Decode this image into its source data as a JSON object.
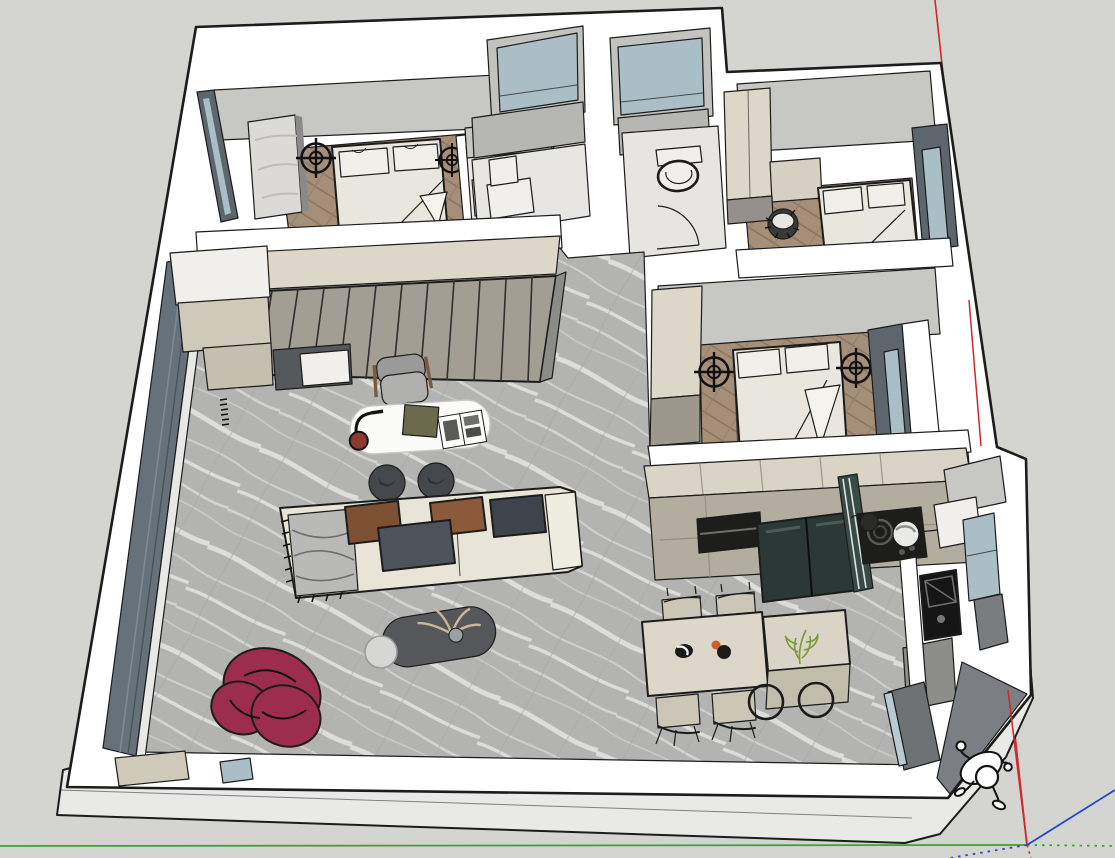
{
  "meta": {
    "viewport": "3d-architecture-model-viewport",
    "style": "sketchup-like-edge-render",
    "canvas_width": 1115,
    "canvas_height": 858
  },
  "palette": {
    "bg": "#d4d4d1",
    "slab": "#e9e9e7",
    "wall_white": "#ffffff",
    "outline": "#1c1c1c",
    "face_gray": "#c7c7c4",
    "face_gray2": "#b6b6b3",
    "reveal_dark": "#5d666c",
    "glass_blue": "#a9bfc5",
    "glass_slate": "#667179",
    "marble_base": "#b3b3b1",
    "marble_vein": "#ebebe9",
    "wood_base": "#a68f79",
    "wood_groove": "#89735e",
    "wardrobe_top": "#dcd7c9",
    "wardrobe_face": "#a39e94",
    "cabinet_beige": "#cfc9ba",
    "counter_top": "#d9d4c6",
    "counter_face": "#b3ada0",
    "dark_appliance": "#1d1d1c",
    "fridge": "#2c3836",
    "fridge_glass": "#3a4a46",
    "bed_cream": "#e9e6de",
    "pillow": "#f1efe9",
    "white_box": "#f0efeb",
    "sofa": "#e8e4d8",
    "cushion_brown1": "#7d4f33",
    "cushion_brown2": "#8a5a3a",
    "cushion_dark1": "#4e525a",
    "cushion_dark2": "#3f434b",
    "throw_gray": "#b9b9b7",
    "armchair": "#9c2d50",
    "coffee_table": "#55575b",
    "side_table": "#d6d6d4",
    "desk": "#fbfbfa",
    "stool_dark": "#44474c",
    "dining_table": "#dcd7c9",
    "chair_beige": "#ccc6b6",
    "island": "#d9d4c6",
    "plant_green": "#7a9a3a",
    "door_dark": "#6e7275",
    "entry_wedge": "#7b7f83",
    "lamp_base_red": "#8d3a30",
    "axis_red": "#cc2a2a",
    "axis_green": "#3aa335",
    "axis_blue": "#2047c8",
    "symbol_black": "#111111"
  },
  "axes": {
    "origin_x": 1027,
    "origin_y": 845,
    "red_solid": "vertical-axis-through-model",
    "green_solid": "left-of-origin",
    "green_dotted": "right-of-origin",
    "blue_solid": "up-right-of-origin",
    "blue_dotted": "down-left-of-origin"
  },
  "scene": {
    "rooms": [
      {
        "name": "bedroom-1",
        "floor": "herringbone-wood",
        "items": [
          "double-bed",
          "pillows",
          "ceiling-light-symbol x2",
          "marble-side-cabinet",
          "window",
          "niche-vanity"
        ]
      },
      {
        "name": "laundry-room",
        "items": [
          "window",
          "washer-boxes"
        ]
      },
      {
        "name": "storage-room",
        "items": [
          "window"
        ]
      },
      {
        "name": "bathroom",
        "items": [
          "toilet",
          "door-swing-arc"
        ]
      },
      {
        "name": "bedroom-2",
        "floor": "herringbone-wood",
        "items": [
          "bed",
          "wardrobe",
          "fringed-pouf",
          "window"
        ]
      },
      {
        "name": "bedroom-3",
        "floor": "herringbone-wood",
        "items": [
          "double-bed",
          "pillows",
          "ceiling-light-symbol x2",
          "wardrobe",
          "window"
        ]
      },
      {
        "name": "living-room",
        "floor": "gray-marble",
        "items": [
          "slatted-wardrobe",
          "side-cabinets",
          "white-desk",
          "desk-lamp",
          "book",
          "open-magazine",
          "desk-chair",
          "stool x2",
          "sofa",
          "chaise-throw",
          "cushions x4",
          "coffee-table",
          "pampas-decor",
          "side-table",
          "burgundy-armchair",
          "full-height-window"
        ]
      },
      {
        "name": "kitchen",
        "items": [
          "upper-counter",
          "base-cabinets",
          "oven-niche",
          "fridge",
          "fridge-glass-door",
          "cooktop",
          "pan",
          "pot",
          "bay-window",
          "appliance-stack"
        ]
      },
      {
        "name": "dining-area",
        "items": [
          "dining-table",
          "dining-chair x4",
          "island-cabinet",
          "potted-plant",
          "round-stool x2",
          "bowl",
          "fruit"
        ]
      },
      {
        "name": "entry",
        "items": [
          "entry-door-dark",
          "glass-sliver",
          "exterior-wedge"
        ]
      }
    ],
    "symbols": {
      "ceiling_light_symbol": "circle-crosshair",
      "count": 4
    },
    "figure": "scale-person-top-view",
    "ground": "floor-slab"
  }
}
